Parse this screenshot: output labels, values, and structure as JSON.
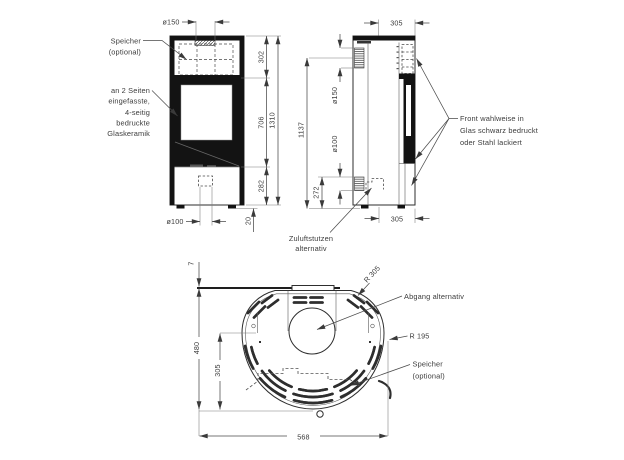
{
  "front": {
    "dims": {
      "d150": "ø150",
      "h302": "302",
      "h706": "706",
      "h1310": "1310",
      "h282": "282",
      "h20": "20",
      "d100": "ø100"
    },
    "speicher_label": [
      "Speicher",
      "(optional)"
    ],
    "glass_label": [
      "an 2 Seiten",
      "eingefasste,",
      "4-seitig",
      "bedruckte",
      "Glaskeramik"
    ]
  },
  "side": {
    "dims": {
      "d305_top": "305",
      "h1137": "1137",
      "d150": "ø150",
      "d100": "ø100",
      "h272": "272",
      "d305_bottom": "305"
    },
    "zuluft_label": [
      "Zuluftstutzen",
      "alternativ"
    ],
    "front_label": [
      "Front wahlweise in",
      "Glas schwarz bedruckt",
      "oder Stahl lackiert"
    ]
  },
  "top": {
    "dims": {
      "g7": "7",
      "d480": "480",
      "d305": "305",
      "w568": "568"
    },
    "r305": "R 305",
    "r195": "R 195",
    "abgang_label": "Abgang alternativ",
    "speicher_label": [
      "Speicher",
      "(optional)"
    ]
  },
  "colors": {
    "line": "#2e2e2e",
    "dim": "#4a4a4a",
    "text": "#3c3c3c",
    "dark_fill": "#131313",
    "bg": "#ffffff"
  }
}
